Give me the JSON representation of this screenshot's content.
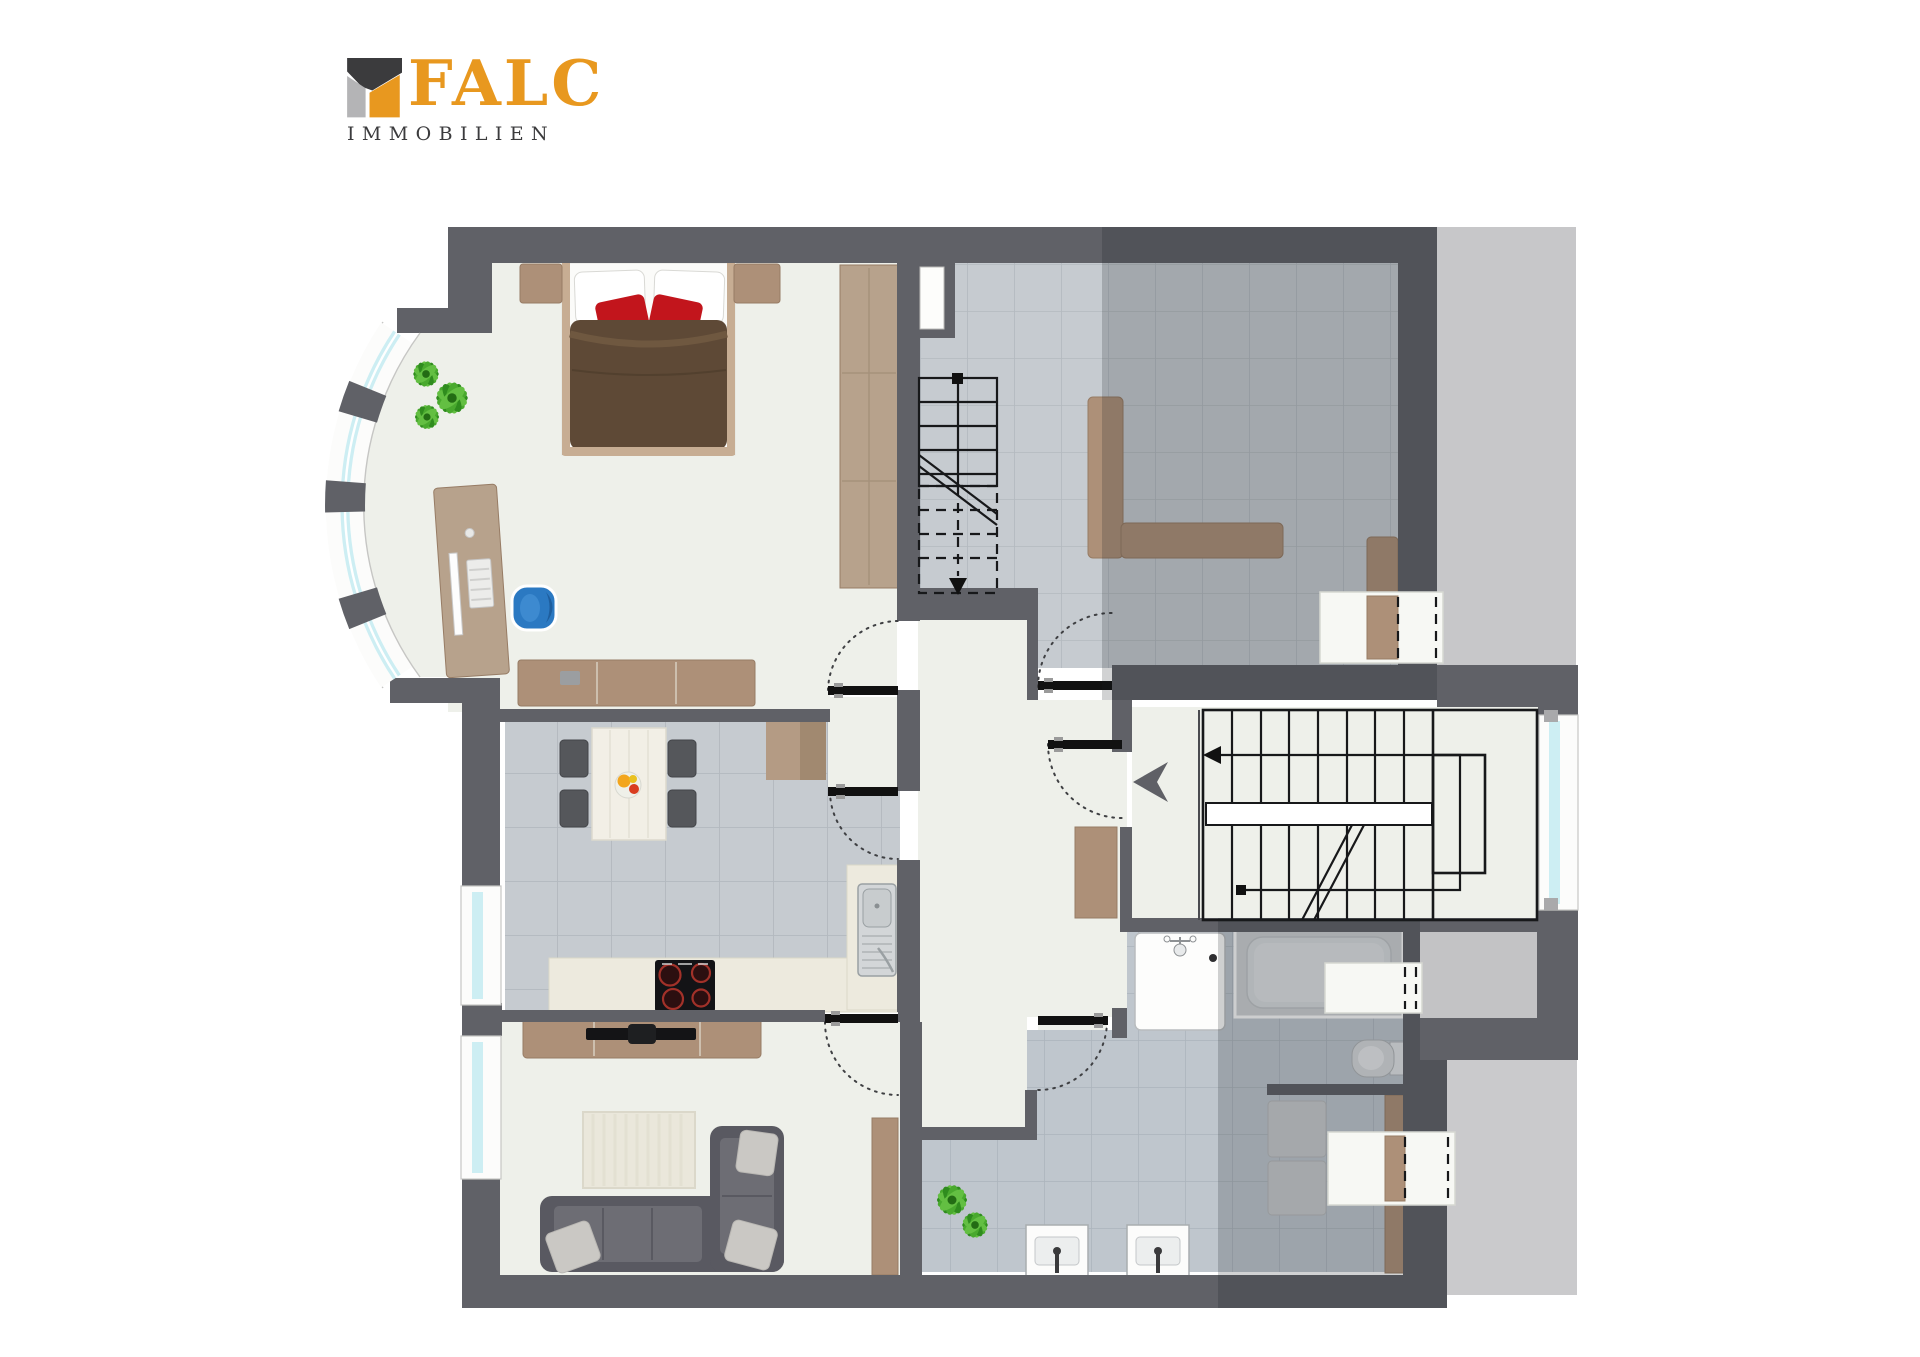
{
  "logo": {
    "brand": "FALC",
    "subtitle": "IMMOBILIEN"
  },
  "colors": {
    "logo_orange": "#e8981f",
    "logo_dark": "#3b3b3d",
    "logo_gray": "#b4b4b6",
    "wall": "#606167",
    "floor": "#eef0ea",
    "tile": "#c6cbd0",
    "tile_line": "#b3b9bf",
    "tile_bath": "#bfc6cd",
    "tile_bath_line": "#acb4bc",
    "exterior": "#c7c7c9",
    "wood": "#ad9078",
    "wood_light": "#b7a28c",
    "wood_dark": "#977c65",
    "counter": "#edeade",
    "duvet": "#5e4936",
    "pillow_red": "#c2151c",
    "sofa": "#595961",
    "sofa_seat": "#6d6d74",
    "cushion": "#cac8c4",
    "rug": "#eae7db",
    "chair_blue": "#2b79c2",
    "plant": "#3f9b28",
    "glass": "#cdeef3",
    "door": "#111111"
  }
}
